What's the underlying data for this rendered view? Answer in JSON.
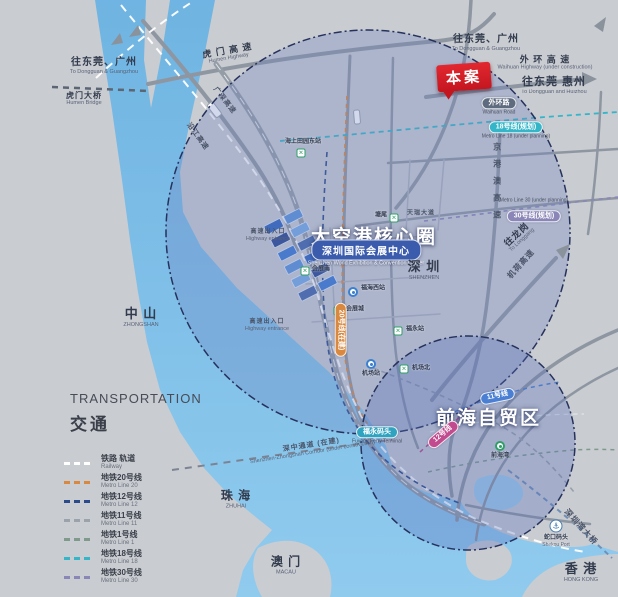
{
  "zones": [
    {
      "id": "dakonggang-core-circle",
      "label": "大空港核心圈"
    },
    {
      "id": "qianhai-free-trade-zone",
      "label": "前海自贸区"
    }
  ],
  "project_badge": {
    "label": "本案"
  },
  "venue_badge": {
    "zh": "深圳国际会展中心",
    "en": "Shenzhen World Exhibition & Convention Center"
  },
  "city_labels": [
    {
      "id": "to-dongguan-guangzhou-nw",
      "zh": "往东莞、广州",
      "en": "To Dongguan & Guangzhou",
      "x": 104,
      "y": 66,
      "size": 10
    },
    {
      "id": "humen-bridge",
      "zh": "虎门大桥",
      "en": "Humen Bridge",
      "x": 84,
      "y": 99,
      "size": 8
    },
    {
      "id": "humen-highway",
      "zh": "虎 门 高 速",
      "en": "Humen Highway",
      "x": 228,
      "y": 54,
      "size": 9,
      "rot": -10
    },
    {
      "id": "to-dongguan-guangzhou-ne",
      "zh": "往东莞、广州",
      "en": "To Dongguan & Guangzhou",
      "x": 486,
      "y": 43,
      "size": 10
    },
    {
      "id": "waihuan-highway",
      "zh": "外 环 高 速",
      "en": "Waihuan Highway (under construction)",
      "x": 545,
      "y": 63,
      "size": 9
    },
    {
      "id": "to-dongguan-huizhou",
      "zh": "往东莞 惠州",
      "en": "To Dongguan and Huizhou",
      "x": 554,
      "y": 86,
      "size": 11
    },
    {
      "id": "shenzhen",
      "zh": "深 圳",
      "en": "SHENZHEN",
      "x": 424,
      "y": 271,
      "size": 13
    },
    {
      "id": "zhongshan",
      "zh": "中 山",
      "en": "ZHONGSHAN",
      "x": 141,
      "y": 318,
      "size": 13
    },
    {
      "id": "zhuhai",
      "zh": "珠 海",
      "en": "ZHUHAI",
      "x": 236,
      "y": 500,
      "size": 12
    },
    {
      "id": "macau",
      "zh": "澳 门",
      "en": "MACAU",
      "x": 286,
      "y": 566,
      "size": 12
    },
    {
      "id": "hongkong",
      "zh": "香 港",
      "en": "HONG KONG",
      "x": 581,
      "y": 573,
      "size": 13
    }
  ],
  "road_labels": [
    {
      "id": "to-longgang",
      "zh": "往龙岗",
      "en": "To Longgang",
      "x": 519,
      "y": 237,
      "size": 9,
      "rot": -43
    },
    {
      "id": "jihe-expressway",
      "zh": "机荷高速",
      "x": 521,
      "y": 264,
      "size": 8,
      "rot": -48,
      "cls": "faint"
    },
    {
      "id": "jinggangao-expressway",
      "zh": "京港澳高速",
      "x": 497,
      "y": 185,
      "size": 8,
      "vertical": true,
      "cls": "faint"
    },
    {
      "id": "yanjiang-expressway",
      "zh": "沿江高速",
      "x": 197,
      "y": 137,
      "size": 7,
      "rot": 54,
      "cls": "faint"
    },
    {
      "id": "guangshen-expressway",
      "zh": "广深高速",
      "x": 224,
      "y": 101,
      "size": 7,
      "rot": 52,
      "cls": "faint"
    },
    {
      "id": "shenzhong-corridor",
      "zh": "深中通道 (在建)",
      "en": "Shenzhen-Zhongshan Corridor (under construction)",
      "x": 312,
      "y": 449,
      "size": 7,
      "rot": -9,
      "cls": "faint"
    },
    {
      "id": "shenzhen-bay-bridge",
      "zh": "深圳湾大桥",
      "x": 581,
      "y": 527,
      "size": 8,
      "rot": 48,
      "cls": "faint"
    },
    {
      "id": "expressway-exit-north",
      "zh": "高速出入口",
      "en": "Highway entrance",
      "x": 268,
      "y": 236,
      "size": 6,
      "cls": "faint"
    },
    {
      "id": "expressway-exit-south",
      "zh": "高速出入口",
      "en": "Highway entrance",
      "x": 267,
      "y": 326,
      "size": 6,
      "cls": "faint"
    },
    {
      "id": "tianrui-avenue",
      "zh": "天瑞大道",
      "x": 421,
      "y": 214,
      "size": 6,
      "cls": "faint"
    }
  ],
  "stations": [
    {
      "id": "haishang-tianyuan-east",
      "zh": "海上田园东站",
      "marker": "x",
      "x": 301,
      "y": 153,
      "lx": 303,
      "ly": 146,
      "align": "above"
    },
    {
      "id": "tangwei",
      "zh": "塘尾",
      "marker": "x",
      "x": 394,
      "y": 218,
      "lx": 387,
      "ly": 216,
      "align": "left"
    },
    {
      "id": "huizhan-south",
      "zh": "会展南",
      "marker": "x",
      "x": 305,
      "y": 271,
      "lx": 312,
      "ly": 270,
      "align": "right"
    },
    {
      "id": "fuhai-west",
      "zh": "福海西站",
      "marker": "circle",
      "x": 353,
      "y": 292,
      "lx": 361,
      "ly": 289,
      "align": "right"
    },
    {
      "id": "huizhan-city",
      "zh": "会展城",
      "marker": "x",
      "x": 338,
      "y": 311,
      "lx": 346,
      "ly": 310,
      "align": "right"
    },
    {
      "id": "fuyong",
      "zh": "福永站",
      "marker": "x",
      "x": 398,
      "y": 331,
      "lx": 406,
      "ly": 330,
      "align": "right"
    },
    {
      "id": "airport",
      "zh": "机场站",
      "marker": "circle",
      "x": 371,
      "y": 364,
      "lx": 371,
      "ly": 371,
      "align": "below"
    },
    {
      "id": "airport-north",
      "zh": "机场北",
      "marker": "x",
      "x": 404,
      "y": 369,
      "lx": 412,
      "ly": 369,
      "align": "right"
    },
    {
      "id": "qianhai-bay",
      "zh": "前海湾",
      "marker": "circle-green",
      "x": 500,
      "y": 446,
      "lx": 500,
      "ly": 453,
      "align": "below"
    },
    {
      "id": "shekou-port",
      "zh": "蛇口码头",
      "en": "Shekou Port",
      "marker": "anchor",
      "x": 556,
      "y": 526,
      "lx": 556,
      "ly": 535,
      "align": "below"
    }
  ],
  "pills": [
    {
      "id": "waihuan-road",
      "zh": "外环路",
      "en": "Waihuan Road",
      "x": 499,
      "y": 103,
      "bg": "#5f6b7e"
    },
    {
      "id": "metro-line-18",
      "zh": "18号线(规划)",
      "en": "Metro Line 18 (under planning)",
      "x": 516,
      "y": 127,
      "bg": "#35b6c8"
    },
    {
      "id": "metro-line-30",
      "zh": "30号线(规划)",
      "en": "Metro Line 30 (under planning)",
      "x": 534,
      "y": 210,
      "bg": "#8b86b8",
      "en_above": true
    },
    {
      "id": "metro-line-20",
      "zh": "20号线(在建)",
      "x": 344,
      "y": 330,
      "bg": "#d9883f",
      "rot": 90
    },
    {
      "id": "metro-line-11",
      "zh": "11号线",
      "x": 497,
      "y": 393,
      "bg": "#4a7fd4",
      "rot": -12
    },
    {
      "id": "metro-line-12",
      "zh": "12号线",
      "x": 441,
      "y": 432,
      "bg": "#c24a8e",
      "rot": -40
    },
    {
      "id": "fuyong-ferry",
      "zh": "福永码头",
      "en": "Fuyong Ferry Terminal",
      "x": 377,
      "y": 432,
      "bg": "#2fa3c0"
    }
  ],
  "legend": {
    "title_en": "TRANSPORTATION",
    "title_zh": "交通",
    "items": [
      {
        "zh": "铁路 轨道",
        "en": "Railway",
        "color": "#ffffff"
      },
      {
        "zh": "地铁20号线",
        "en": "Metro Line 20",
        "color": "#d9883f"
      },
      {
        "zh": "地铁12号线",
        "en": "Metro Line 12",
        "color": "#2b4a8b"
      },
      {
        "zh": "地铁11号线",
        "en": "Metro Line 11",
        "color": "#9aa2ac"
      },
      {
        "zh": "地铁1号线",
        "en": "Metro Line 1",
        "color": "#7f9a8a"
      },
      {
        "zh": "地铁18号线",
        "en": "Metro Line 18",
        "color": "#35b6c8"
      },
      {
        "zh": "地铁30号线",
        "en": "Metro Line 30",
        "color": "#8b86b8"
      }
    ]
  },
  "colors": {
    "land": "#c9ccd1",
    "water": "#7fc0e8",
    "zone_fill": "#6c80c0",
    "zone_border": "#26325c",
    "accent_red": "#d8232a",
    "venue_blue": "#3b5cad",
    "road": "#8e96a1"
  }
}
